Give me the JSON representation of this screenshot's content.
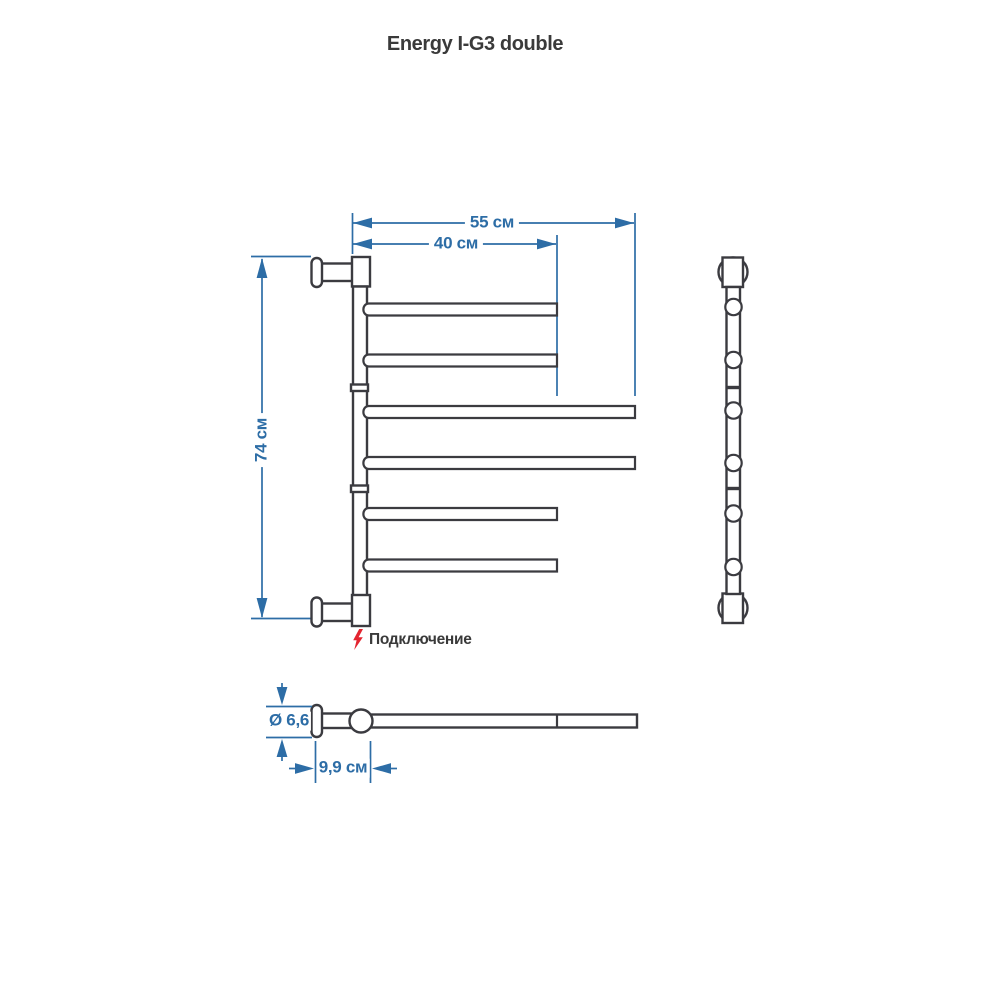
{
  "title": "Energy I-G3 double",
  "colors": {
    "outline": "#3b3b40",
    "dimension_blue": "#2d6da6",
    "accent_red": "#e32530",
    "text": "#3a3a3a"
  },
  "front_view": {
    "width_label": "55 см",
    "inner_width_label": "40 см",
    "height_label": "74 см",
    "connection_label": "Подключение"
  },
  "plan_view": {
    "diameter_label": "Ø 6,6",
    "depth_label": "9,9 см"
  }
}
